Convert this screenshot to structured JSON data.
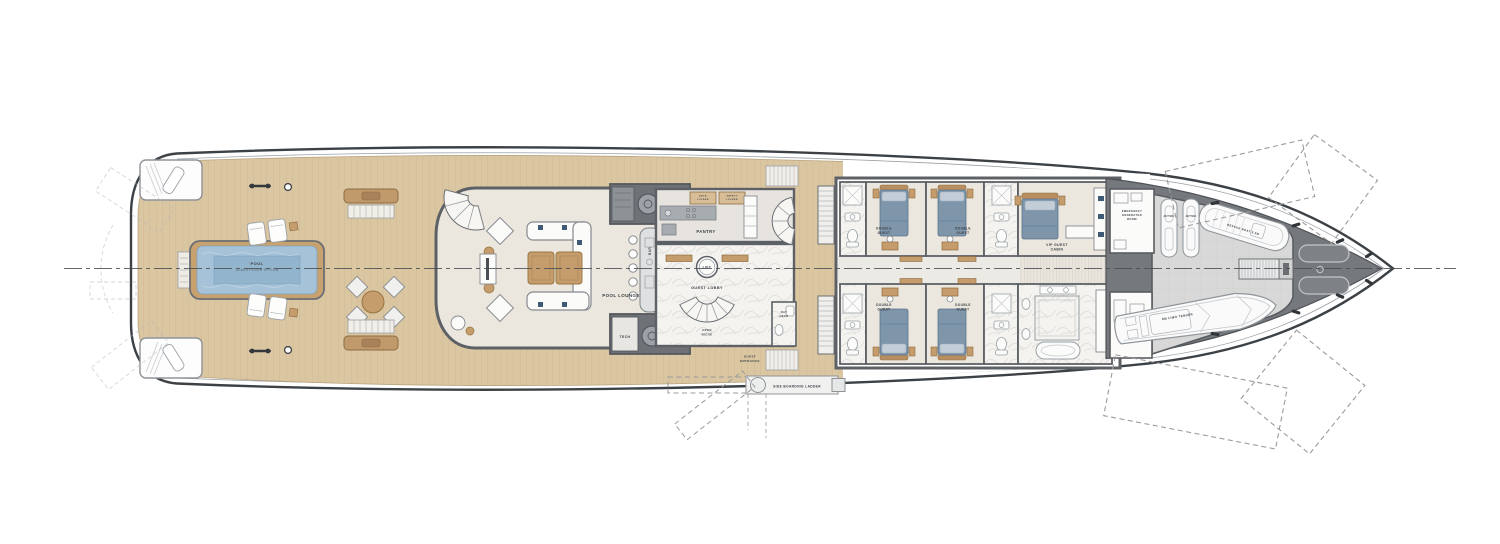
{
  "plan": {
    "labels": {
      "pool": {
        "line1": "POOL",
        "line2": "GLASS FLOOR OPTION"
      },
      "pool_lounge": "POOL LOUNGE",
      "bar": "BAR",
      "tech": "TECH",
      "pantry": "PANTRY",
      "deck_locker": {
        "line1": "DECK",
        "line2": "LOCKER"
      },
      "safety_locker": {
        "line1": "SAFETY",
        "line2": "LOCKER"
      },
      "lift": "LIFT",
      "guest_lobby": "GUEST LOBBY",
      "open_niche": {
        "line1": "OPEN",
        "line2": "NICHE"
      },
      "day_head": {
        "line1": "DAY",
        "line2": "HEAD"
      },
      "guest_entrance": {
        "line1": "GUEST",
        "line2": "ENTRANCE"
      },
      "side_boarding_ladder": "SIDE BOARDING LADDER",
      "double_guest": {
        "line1": "DOUBLE",
        "line2": "GUEST"
      },
      "vip": {
        "line1": "VIP GUEST",
        "line2": "CABIN"
      },
      "emergency_generator": {
        "line1": "EMERGENCY",
        "line2": "GENERATOR",
        "line3": "ROOM"
      },
      "jetski": "JETSKI",
      "rescue_boat": "RESCUE BOAT 5.5M",
      "limo_tender": "8M LIMO TENDER"
    }
  },
  "colors": {
    "hull_outline": "#3c4146",
    "teak": "#dbc6a2",
    "teak_line": "#c6ab81",
    "interior": "#ece7de",
    "wall": "#5d6166",
    "marble": "#f4f3f0",
    "pool_water": "#a6c2d8",
    "pool_water_deep": "#93b4cd",
    "wood_furniture": "#c59c6c",
    "bed_blue": "#7e95aa",
    "dark_deck": "#6e7277",
    "bow_deck": "#75797d",
    "garage_floor": "#d7d8d7",
    "dash_line": "#9b9b9b"
  }
}
